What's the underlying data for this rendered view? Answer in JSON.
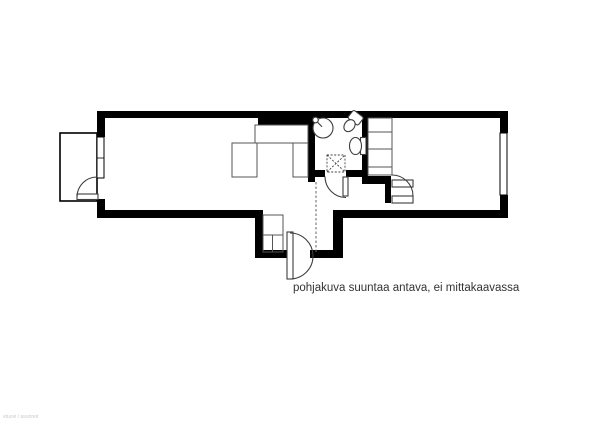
{
  "caption": "pohjakuva suuntaa antava, ei mittakaavassa",
  "watermark": "etuovi / asunnot",
  "colors": {
    "wall": "#000000",
    "fixture_line": "#3d3d3d",
    "caption_text": "#333333",
    "watermark_text": "#c9c9c9",
    "background": "#ffffff"
  },
  "plan": {
    "fixtures": [
      "balcony",
      "balcony-window",
      "balcony-door",
      "kitchen-counter",
      "table",
      "bathroom-sink",
      "bathroom-corner-basin",
      "bathroom-toilet",
      "washing-machine-reservation",
      "bathroom-door",
      "hall-wardrobe",
      "entrance-door",
      "bedroom-wardrobe",
      "bedroom-door",
      "bedroom-window"
    ]
  }
}
